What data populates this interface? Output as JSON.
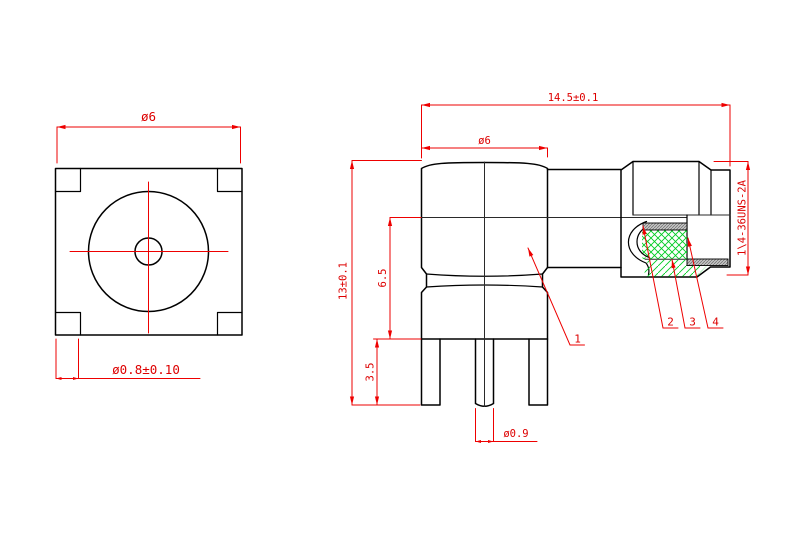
{
  "front_view": {
    "flange_dia": "ø6",
    "leg_dia": "ø0.8±0.10"
  },
  "side_view": {
    "overall_length": "14.5±0.1",
    "body_dia": "ø6",
    "overall_height": "13±0.1",
    "body_height": "6.5",
    "leg_length": "3.5",
    "pin_dia": "ø0.9",
    "thread_spec": "1\\4-36UNS-2A",
    "part_labels": [
      "1",
      "2",
      "3",
      "4"
    ]
  },
  "colors": {
    "line": "#000000",
    "dimension_red": "#ee0000",
    "hatch_green": "#00cc22",
    "contact_gray": "#c4c4c4"
  }
}
